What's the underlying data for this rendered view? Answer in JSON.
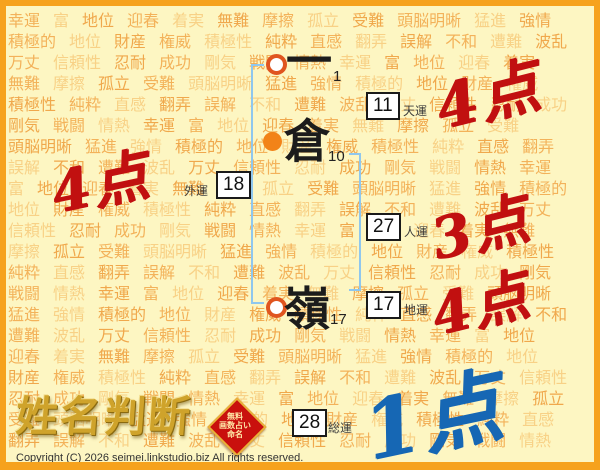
{
  "page": {
    "background_color": "#fdf6c2",
    "border_color": "#f6a21d",
    "watermark_color": "#f3b25a",
    "bracket_color": "#8fc7ee",
    "circle_color": "#f28318"
  },
  "background": {
    "words": [
      "幸運",
      "富",
      "地位",
      "迎春",
      "着実",
      "無難",
      "摩擦",
      "孤立",
      "受難",
      "頭脳明晰",
      "猛進",
      "強情",
      "積極的",
      "地位",
      "財産",
      "権威",
      "積極性",
      "純粋",
      "直感",
      "翻弄",
      "誤解",
      "不和",
      "遭難",
      "波乱",
      "万丈",
      "信頼性",
      "忍耐",
      "成功",
      "剛気",
      "戦闘",
      "情熱"
    ],
    "repeat": 8
  },
  "name": {
    "chars": [
      {
        "char": "一",
        "strokes": "1"
      },
      {
        "char": "倉",
        "strokes": "10"
      },
      {
        "char": "嶺",
        "strokes": "17"
      }
    ]
  },
  "fortunes": {
    "tenun": {
      "value": "11",
      "label": "天運",
      "score": "4点",
      "score_color": "#c11010"
    },
    "jinun": {
      "value": "27",
      "label": "人運",
      "score": "3点",
      "score_color": "#c11010"
    },
    "chiun": {
      "value": "17",
      "label": "地運",
      "score": "4点",
      "score_color": "#c11010"
    },
    "gaiun": {
      "value": "18",
      "label": "外運",
      "score": "4点",
      "score_color": "#c11010"
    },
    "soun": {
      "value": "28",
      "label": "総運",
      "score": "1点",
      "score_color": "#1667b4"
    }
  },
  "footer": {
    "logo_text": "姓名判断",
    "badge_lines": [
      "無料",
      "画数占い",
      "命名"
    ],
    "copyright": "Copyright (C) 2026 seimei.linkstudio.biz All rights reserved."
  }
}
